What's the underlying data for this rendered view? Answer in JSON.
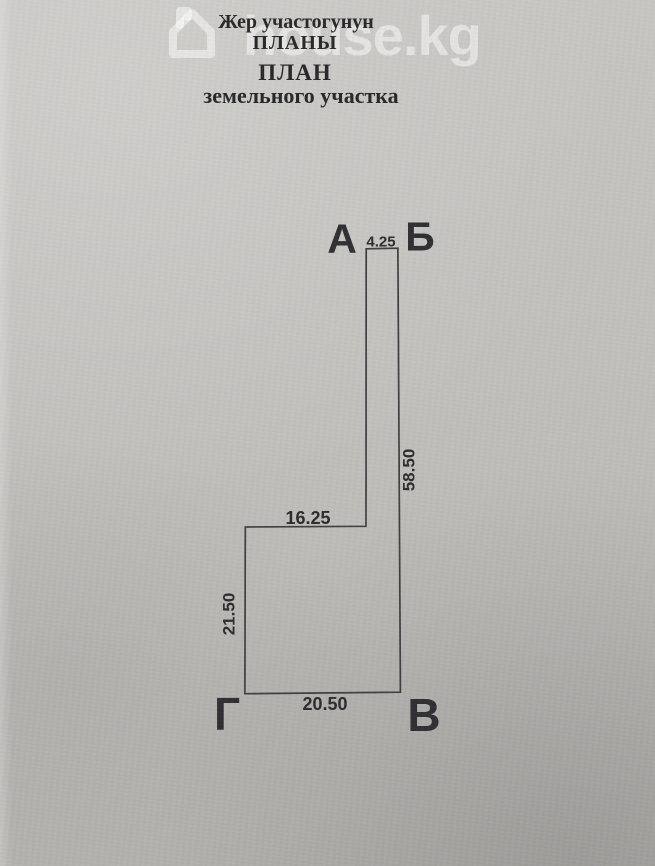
{
  "watermark": {
    "text": "house.kg",
    "icon": "house-outline-icon",
    "color": "rgba(255,255,255,0.5)"
  },
  "header": {
    "kyrgyz_line1": "Жер участогунун",
    "kyrgyz_line2": "ПЛАНЫ",
    "russian_line1": "ПЛАН",
    "russian_line2": "земельного участка"
  },
  "plan": {
    "vertex_labels": {
      "a": "А",
      "b": "Б",
      "v": "В",
      "g": "Г"
    },
    "dimensions": {
      "ab_top": "4.25",
      "bv_right": "58.50",
      "ledge": "16.25",
      "left_side": "21.50",
      "gv_bottom": "20.50"
    },
    "line_color": "#3f3f41"
  }
}
